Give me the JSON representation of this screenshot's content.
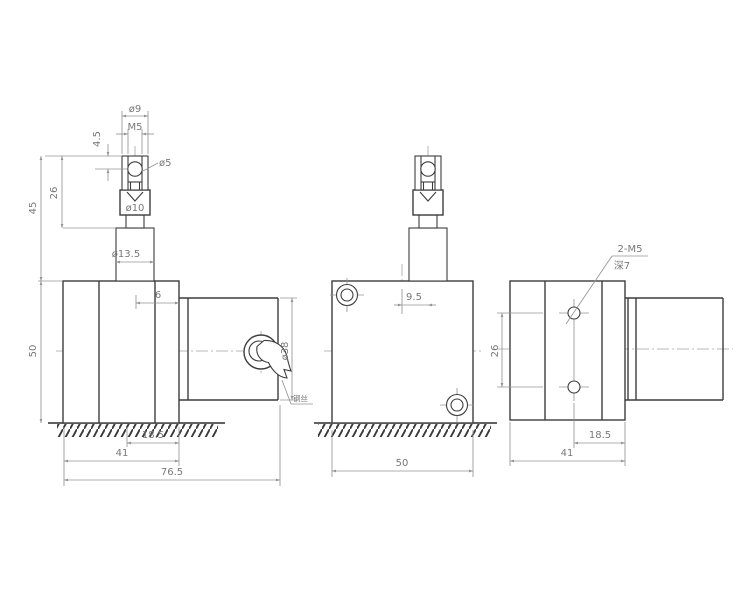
{
  "labels": {
    "front": {
      "dia9": "ø9",
      "m5": "M5",
      "h4_5": "4.5",
      "dia5": "ø5",
      "dia10": "ø10",
      "dia13_5": "ø13.5",
      "h45": "45",
      "h26": "26",
      "w6": "6",
      "h50": "50",
      "dia38": "ø38",
      "wire_note": "钢丝",
      "w18_5": "18.5",
      "w41": "41",
      "w76_5": "76.5"
    },
    "side": {
      "off9_5": "9.5",
      "w50": "50"
    },
    "rear": {
      "thread": "2-M5",
      "depth": "深7",
      "h26": "26",
      "w18_5": "18.5",
      "w41": "41"
    }
  },
  "line_colors": {
    "object": "#3d3d3d",
    "dimension": "#949494",
    "centerline": "#a2a2a2",
    "text": "#787878"
  }
}
